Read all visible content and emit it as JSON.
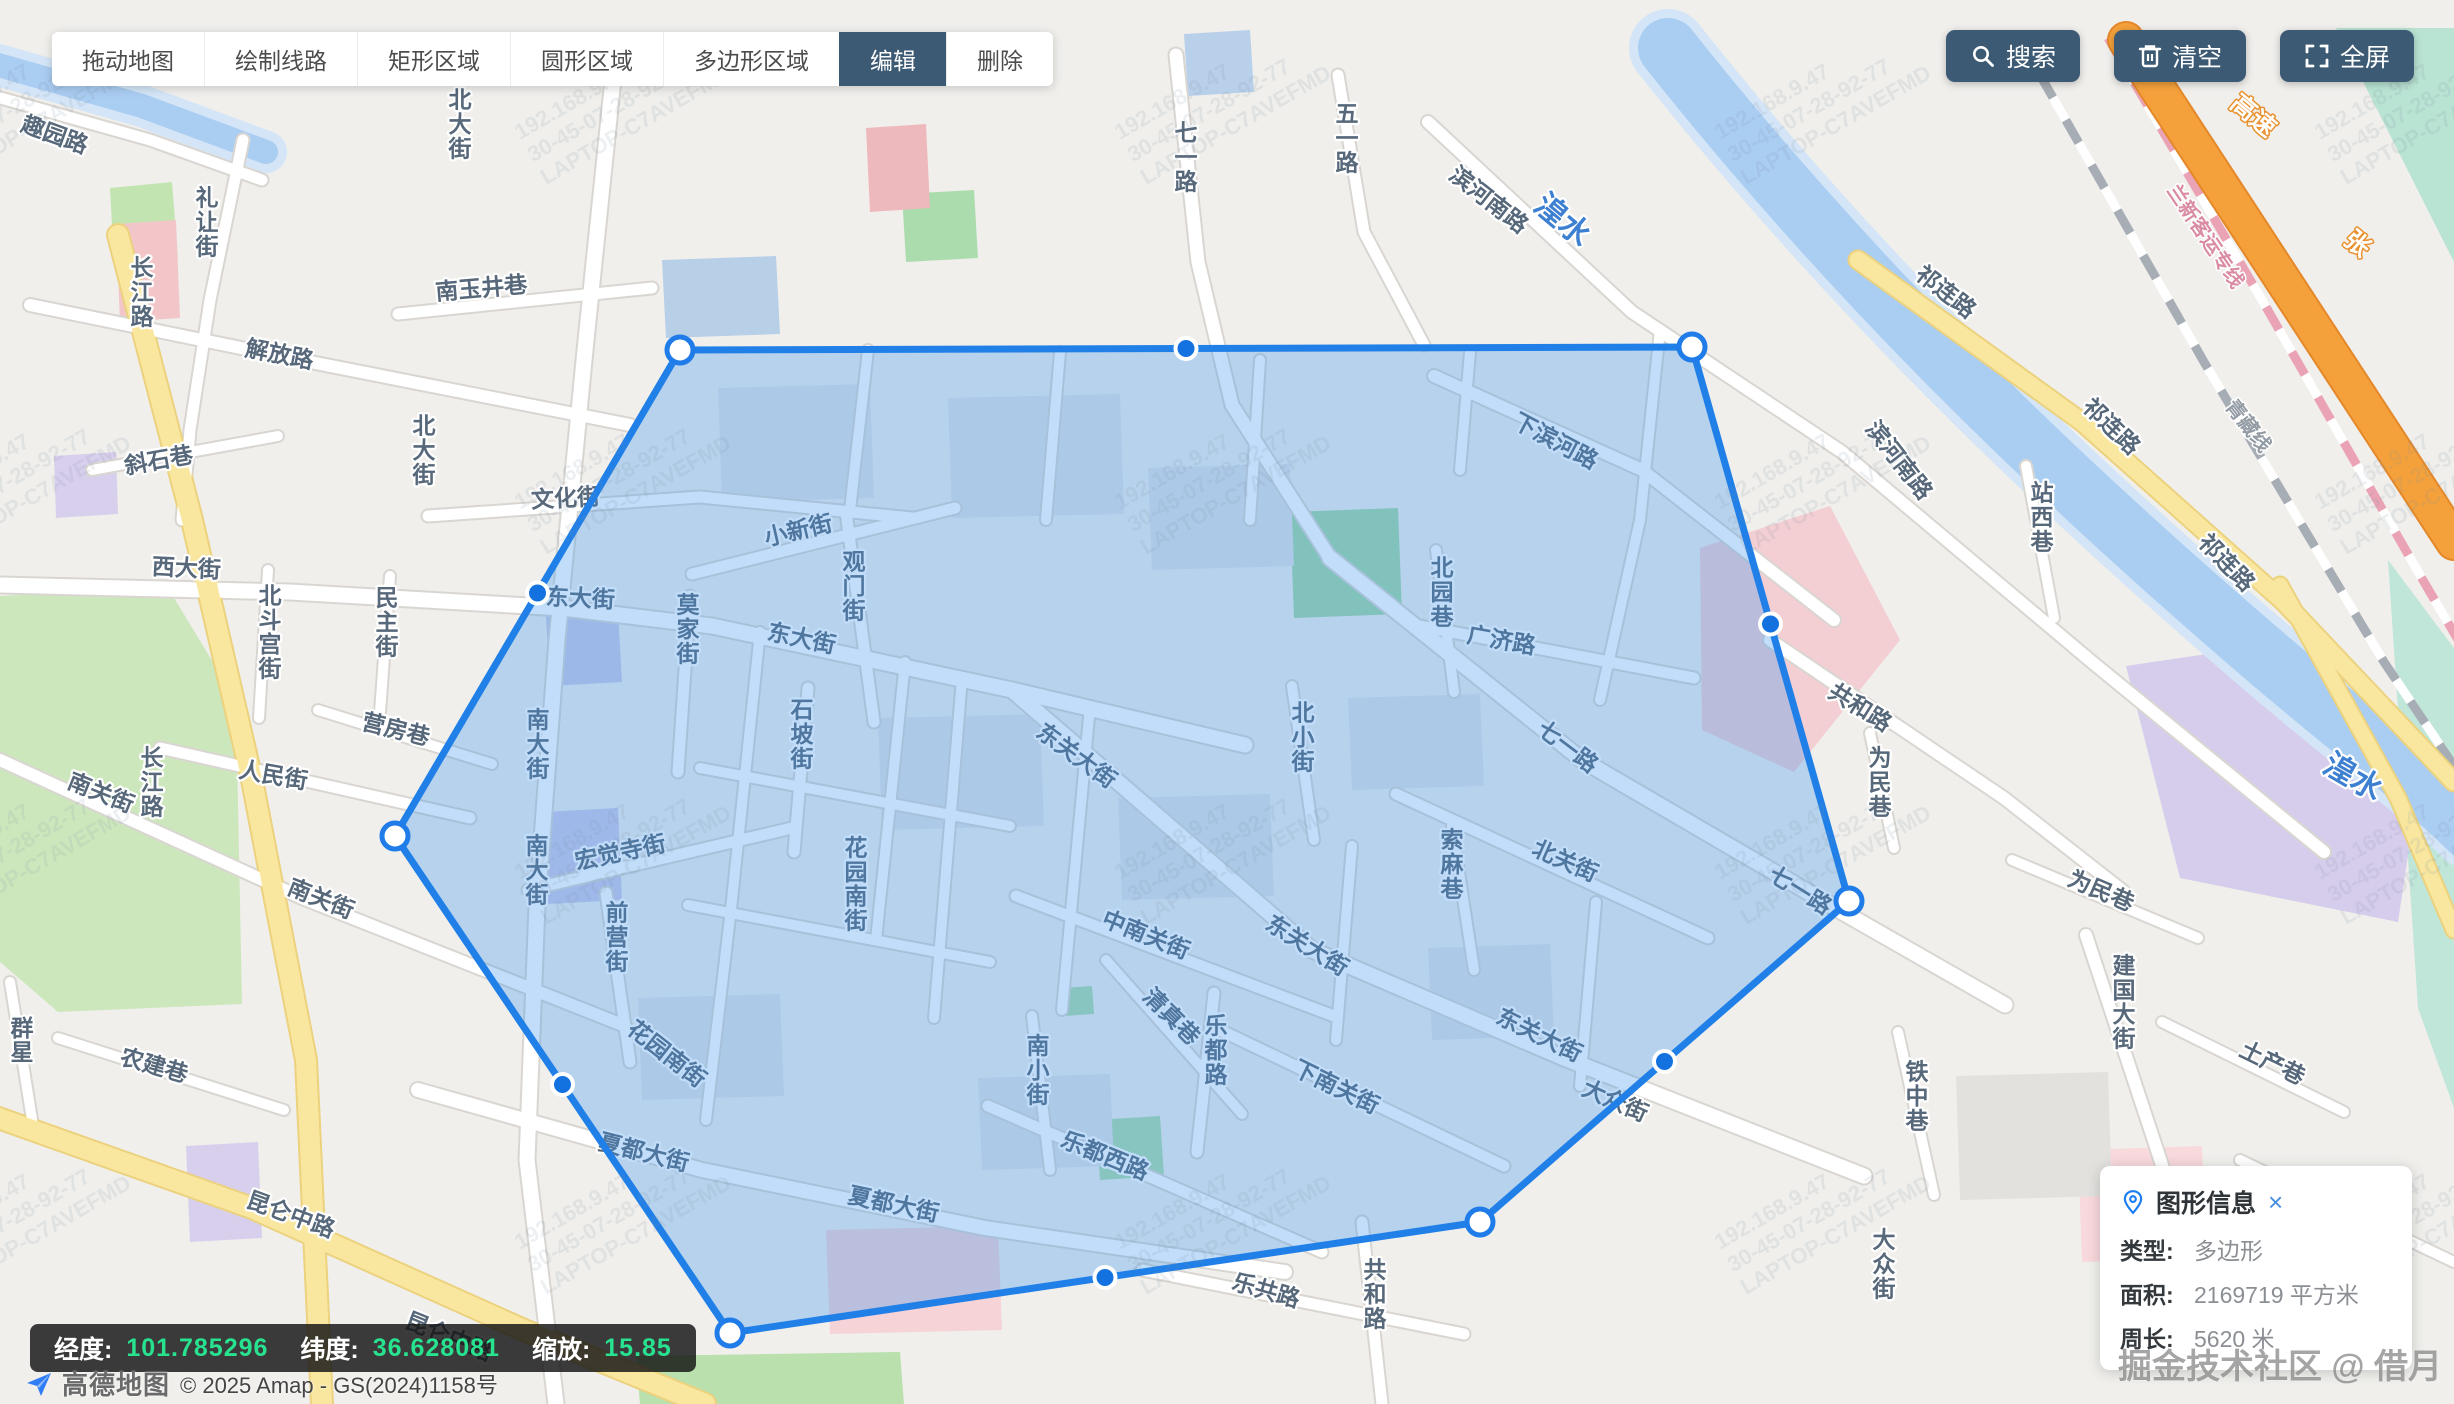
{
  "toolbar": {
    "buttons": [
      {
        "name": "tool-drag-map",
        "label": "拖动地图",
        "active": false
      },
      {
        "name": "tool-draw-line",
        "label": "绘制线路",
        "active": false
      },
      {
        "name": "tool-rect-area",
        "label": "矩形区域",
        "active": false
      },
      {
        "name": "tool-circle-area",
        "label": "圆形区域",
        "active": false
      },
      {
        "name": "tool-polygon-area",
        "label": "多边形区域",
        "active": false
      },
      {
        "name": "tool-edit",
        "label": "编辑",
        "active": true
      },
      {
        "name": "tool-delete",
        "label": "删除",
        "active": false
      }
    ],
    "actions": [
      {
        "name": "search-button",
        "icon": "search-icon",
        "label": "搜索"
      },
      {
        "name": "clear-button",
        "icon": "trash-icon",
        "label": "清空"
      },
      {
        "name": "fullscreen-button",
        "icon": "fullscreen-icon",
        "label": "全屏"
      }
    ],
    "active_bg": "#3d5a74"
  },
  "statusbar": {
    "items": [
      {
        "label": "经度:",
        "value": "101.785296"
      },
      {
        "label": "纬度:",
        "value": "36.628081"
      },
      {
        "label": "缩放:",
        "value": "15.85"
      }
    ],
    "value_color": "#27e28f"
  },
  "attribution": {
    "logo_text": "高德地图",
    "copyright": "© 2025 Amap - GS(2024)1158号"
  },
  "info_panel": {
    "title": "图形信息",
    "close_label": "×",
    "rows": [
      {
        "label": "类型:",
        "value": "多边形"
      },
      {
        "label": "面积:",
        "value": "2169719 平方米"
      },
      {
        "label": "周长:",
        "value": "5620 米"
      }
    ]
  },
  "community_watermark": {
    "text": "掘金技术社区 @ 借月"
  },
  "tile_watermark": {
    "lines": [
      "192.168.9.47",
      "30-45-07-28-92-77",
      "LAPTOP-C7AVEFMD"
    ]
  },
  "map": {
    "colors": {
      "land": "#f0efec",
      "road_fill": "#ffffff",
      "road_casing": "#d9d6d2",
      "yellow_fill": "#f9e7a0",
      "yellow_casing": "#ecd27e",
      "orange_fill": "#f4a13b",
      "orange_casing": "#e4882a",
      "river": "#aacdf2",
      "river_shore": "#d3e5f7",
      "polygon_fill": "rgba(62,148,235,0.32)",
      "polygon_stroke": "#2080e8",
      "vertex_fill": "#ffffff",
      "vertex_stroke": "#1f7ce8",
      "midpoint_fill": "#1472e0",
      "midpoint_stroke": "#ffffff"
    },
    "region_polygon": {
      "vertices": [
        [
          680,
          350
        ],
        [
          1692,
          347
        ],
        [
          1849,
          901
        ],
        [
          1480,
          1222
        ],
        [
          730,
          1333
        ],
        [
          395,
          836
        ]
      ]
    },
    "areas": [
      {
        "pts": "0,596 168,588 236,700 242,1004 58,1012 0,962",
        "fill": "#cde7bd"
      },
      {
        "pts": "110,188 172,182 178,258 114,262",
        "fill": "#c2e4b0"
      },
      {
        "pts": "1290,512 1398,508 1402,614 1294,618",
        "fill": "#a2d8a6"
      },
      {
        "pts": "902,194 974,190 978,258 906,262",
        "fill": "#abdcad"
      },
      {
        "pts": "1062,988 1092,986 1094,1014 1064,1016",
        "fill": "#abdcad"
      },
      {
        "pts": "1096,1120 1160,1116 1164,1176 1100,1180",
        "fill": "#abdcad"
      },
      {
        "pts": "636,1356 900,1352 904,1404 640,1404",
        "fill": "#b9e0ad"
      },
      {
        "pts": "2336,28 2454,28 2454,262",
        "fill": "#b9e3d3"
      },
      {
        "pts": "2388,560 2454,648 2454,1108 2418,1008",
        "fill": "#bfe6d9"
      },
      {
        "pts": "116,224 176,220 180,318 120,322",
        "fill": "#f2c6c8"
      },
      {
        "pts": "1700,548 1830,506 1900,640 1794,772 1702,730",
        "fill": "#f3ced3"
      },
      {
        "pts": "826,1230 998,1226 1002,1330 830,1334",
        "fill": "#f6d3d7"
      },
      {
        "pts": "2078,1150 2202,1146 2206,1258 2082,1262",
        "fill": "#f8d9dc"
      },
      {
        "pts": "866,128 926,124 930,208 870,212",
        "fill": "#eeb9bd"
      },
      {
        "pts": "54,456 116,452 118,514 56,518",
        "fill": "#d8cfec"
      },
      {
        "pts": "186,1146 258,1142 262,1238 190,1242",
        "fill": "#d8cfec"
      },
      {
        "pts": "546,616 618,612 622,682 550,686",
        "fill": "#c9c9e8"
      },
      {
        "pts": "544,812 618,808 622,900 548,904",
        "fill": "#cdc9e9"
      },
      {
        "pts": "2126,666 2300,640 2422,762 2398,922 2180,878",
        "fill": "#d6cdec"
      },
      {
        "pts": "662,260 776,256 780,334 666,338",
        "fill": "#b8cfe8"
      },
      {
        "pts": "1184,34 1250,30 1254,92 1188,96",
        "fill": "#b9d0ea"
      },
      {
        "pts": "1956,1076 2108,1072 2112,1196 1960,1200",
        "fill": "#e3e1de"
      },
      {
        "pts": "718,388 870,384 874,498 722,502",
        "fill": "#e0e2e6"
      },
      {
        "pts": "948,398 1120,394 1124,514 952,518",
        "fill": "#e0e2e6"
      },
      {
        "pts": "1148,468 1290,464 1294,566 1152,570",
        "fill": "#e0e2e6"
      },
      {
        "pts": "878,718 1040,714 1044,826 882,830",
        "fill": "#e0e2e6"
      },
      {
        "pts": "1118,798 1270,794 1274,896 1122,900",
        "fill": "#e0e2e6"
      },
      {
        "pts": "1348,698 1480,694 1484,786 1352,790",
        "fill": "#e0e2e6"
      },
      {
        "pts": "638,998 780,994 784,1096 642,1100",
        "fill": "#e0e2e6"
      },
      {
        "pts": "978,1078 1110,1074 1114,1166 982,1170",
        "fill": "#e0e2e6"
      },
      {
        "pts": "1428,948 1550,944 1554,1036 1432,1040",
        "fill": "#e0e2e6"
      }
    ],
    "rivers": [
      {
        "d": "M1668,48 C1860,290 2060,480 2260,652 C2360,738 2420,780 2470,830",
        "w": 60
      },
      {
        "d": "M-12,62 L142,106 L266,152",
        "w": 24
      }
    ],
    "railways": [
      {
        "d": "M2040,75 L2204,362 L2384,662 L2460,775",
        "c": "#a7adb4"
      },
      {
        "d": "M2108,38 L2262,300 L2424,582 L2470,660",
        "c": "#eaa3b4"
      }
    ],
    "roads": [
      {
        "d": "M615,60 L585,350 L557,640 L537,905 L527,1160 L556,1404",
        "t": "w",
        "w": 15
      },
      {
        "d": "M0,585 L290,592 L562,608 L712,626 L1012,690 L1245,745",
        "t": "w",
        "w": 15
      },
      {
        "d": "M1012,690 L1312,950 L1564,1058 L1864,1176",
        "t": "w",
        "w": 15
      },
      {
        "d": "M30,305 L300,360 L630,425",
        "t": "w",
        "w": 12
      },
      {
        "d": "M243,140 L210,300 L190,430 L182,520",
        "t": "w",
        "w": 11
      },
      {
        "d": "M398,314 L652,288",
        "t": "w",
        "w": 11
      },
      {
        "d": "M428,516 L700,497 L912,518",
        "t": "w",
        "w": 11
      },
      {
        "d": "M692,574 L955,508",
        "t": "w",
        "w": 11
      },
      {
        "d": "M846,512 L874,722",
        "t": "w",
        "w": 11
      },
      {
        "d": "M690,596 L678,772",
        "t": "w",
        "w": 11
      },
      {
        "d": "M808,688 L794,852",
        "t": "w",
        "w": 11
      },
      {
        "d": "M528,890 L792,828",
        "t": "w",
        "w": 11
      },
      {
        "d": "M606,893 L630,1062",
        "t": "w",
        "w": 11
      },
      {
        "d": "M160,748 L470,818",
        "t": "w",
        "w": 11
      },
      {
        "d": "M318,710 L492,764",
        "t": "w",
        "w": 10
      },
      {
        "d": "M390,576 L379,726",
        "t": "w",
        "w": 10
      },
      {
        "d": "M268,570 L259,718",
        "t": "w",
        "w": 10
      },
      {
        "d": "M0,760 L302,898 L625,1026",
        "t": "w",
        "w": 12
      },
      {
        "d": "M418,1090 L702,1170 L985,1228 L1285,1272",
        "t": "w",
        "w": 14
      },
      {
        "d": "M1214,993 L1197,1152",
        "t": "w",
        "w": 11
      },
      {
        "d": "M988,1106 L1322,1252",
        "t": "w",
        "w": 11
      },
      {
        "d": "M1016,896 L1334,1016",
        "t": "w",
        "w": 11
      },
      {
        "d": "M1106,960 L1242,1114",
        "t": "w",
        "w": 10
      },
      {
        "d": "M1032,1016 L1050,1170",
        "t": "w",
        "w": 10
      },
      {
        "d": "M1224,1032 L1504,1166",
        "t": "w",
        "w": 11
      },
      {
        "d": "M1396,794 L1708,938",
        "t": "w",
        "w": 11
      },
      {
        "d": "M1452,826 L1474,970",
        "t": "w",
        "w": 10
      },
      {
        "d": "M1292,686 L1314,840",
        "t": "w",
        "w": 10
      },
      {
        "d": "M1330,558 L1582,760 L1832,906 L2005,1005",
        "t": "w",
        "w": 15
      },
      {
        "d": "M1420,626 L1694,678",
        "t": "w",
        "w": 11
      },
      {
        "d": "M1436,550 L1454,692",
        "t": "w",
        "w": 10
      },
      {
        "d": "M1434,376 L1642,470 L1834,620",
        "t": "w",
        "w": 12
      },
      {
        "d": "M1770,640 L2004,798 L2124,892",
        "t": "w",
        "w": 12
      },
      {
        "d": "M1362,1222 L1382,1404",
        "t": "w",
        "w": 11
      },
      {
        "d": "M1142,1270 L1464,1334",
        "t": "w",
        "w": 11
      },
      {
        "d": "M1870,733 L1894,848",
        "t": "w",
        "w": 10
      },
      {
        "d": "M2012,860 L2198,938",
        "t": "w",
        "w": 10
      },
      {
        "d": "M2086,935 L2162,1165 L2202,1340",
        "t": "w",
        "w": 12
      },
      {
        "d": "M2162,1022 L2344,1112",
        "t": "w",
        "w": 10
      },
      {
        "d": "M1898,1032 L1934,1195",
        "t": "w",
        "w": 10
      },
      {
        "d": "M1428,122 L1632,312 L1842,452 L2092,662 L2324,852",
        "t": "w",
        "w": 12
      },
      {
        "d": "M1338,75 L1364,232 L1424,345",
        "t": "w",
        "w": 11
      },
      {
        "d": "M1176,55 L1198,262 L1232,405 L1330,558",
        "t": "w",
        "w": 13
      },
      {
        "d": "M2026,466 L2054,618",
        "t": "w",
        "w": 10
      },
      {
        "d": "M58,1038 L284,1110",
        "t": "w",
        "w": 10
      },
      {
        "d": "M10,982 L34,1132",
        "t": "w",
        "w": 10
      },
      {
        "d": "M92,470 L278,436",
        "t": "w",
        "w": 10
      },
      {
        "d": "M-10,95 L150,140 L262,180",
        "t": "w",
        "w": 11
      },
      {
        "d": "M760,632 L732,900 L706,1120",
        "t": "w",
        "w": 10
      },
      {
        "d": "M905,662 L876,940",
        "t": "w",
        "w": 10
      },
      {
        "d": "M962,678 L934,1018",
        "t": "w",
        "w": 10
      },
      {
        "d": "M1090,706 L1062,1010",
        "t": "w",
        "w": 10
      },
      {
        "d": "M700,768 L1010,826",
        "t": "w",
        "w": 10
      },
      {
        "d": "M688,905 L990,962",
        "t": "w",
        "w": 10
      },
      {
        "d": "M1352,846 L1336,1040",
        "t": "w",
        "w": 10
      },
      {
        "d": "M1596,902 L1580,1086",
        "t": "w",
        "w": 10
      },
      {
        "d": "M1660,330 L1640,520 L1600,700",
        "t": "w",
        "w": 10
      },
      {
        "d": "M868,350 L850,510",
        "t": "w",
        "w": 10
      },
      {
        "d": "M1060,352 L1046,520",
        "t": "w",
        "w": 10
      },
      {
        "d": "M1260,360 L1250,520",
        "t": "w",
        "w": 10
      },
      {
        "d": "M1470,352 L1460,470",
        "t": "w",
        "w": 10
      },
      {
        "d": "M2240,1160 L2454,1262",
        "t": "w",
        "w": 10
      },
      {
        "d": "M118,235 L192,520 L252,780 L306,1060 L322,1404",
        "t": "y",
        "w": 20
      },
      {
        "d": "M-10,1115 L252,1208 L524,1330 L705,1404",
        "t": "y",
        "w": 20
      },
      {
        "d": "M1858,260 L2082,422 L2284,602 L2454,782",
        "t": "y",
        "w": 17
      },
      {
        "d": "M2280,585 L2398,798 L2454,930",
        "t": "y",
        "w": 15
      },
      {
        "d": "M2126,40 L2454,542",
        "t": "o",
        "w": 34
      }
    ],
    "labels": [
      {
        "t": "趣园路",
        "x": 52,
        "y": 142,
        "r": 20
      },
      {
        "t": "长江路",
        "x": 142,
        "y": 300,
        "v": 1
      },
      {
        "t": "长江路",
        "x": 152,
        "y": 790,
        "v": 1
      },
      {
        "t": "礼让街",
        "x": 207,
        "y": 230,
        "v": 1
      },
      {
        "t": "南玉井巷",
        "x": 482,
        "y": 296,
        "r": -5
      },
      {
        "t": "解放路",
        "x": 278,
        "y": 362,
        "r": 11
      },
      {
        "t": "斜石巷",
        "x": 160,
        "y": 468,
        "r": -10
      },
      {
        "t": "北大街",
        "x": 460,
        "y": 132,
        "v": 1
      },
      {
        "t": "北大街",
        "x": 424,
        "y": 458,
        "v": 1
      },
      {
        "t": "西大街",
        "x": 186,
        "y": 576,
        "r": 3
      },
      {
        "t": "文化街",
        "x": 566,
        "y": 506,
        "r": -3
      },
      {
        "t": "民主街",
        "x": 387,
        "y": 630,
        "v": 1
      },
      {
        "t": "北斗宫街",
        "x": 270,
        "y": 640,
        "v": 1
      },
      {
        "t": "营房巷",
        "x": 394,
        "y": 737,
        "r": 14
      },
      {
        "t": "人民街",
        "x": 272,
        "y": 783,
        "r": 10
      },
      {
        "t": "南关街",
        "x": 98,
        "y": 800,
        "r": 22
      },
      {
        "t": "南关街",
        "x": 318,
        "y": 906,
        "r": 22
      },
      {
        "t": "群星",
        "x": 22,
        "y": 1048,
        "v": 1
      },
      {
        "t": "农建巷",
        "x": 152,
        "y": 1073,
        "r": 16
      },
      {
        "t": "昆仑中路",
        "x": 288,
        "y": 1222,
        "r": 20
      },
      {
        "t": "昆仑中路",
        "x": 446,
        "y": 1344,
        "r": 22
      },
      {
        "t": "东大街",
        "x": 580,
        "y": 606,
        "r": 3
      },
      {
        "t": "小新街",
        "x": 800,
        "y": 538,
        "r": -13
      },
      {
        "t": "观门街",
        "x": 854,
        "y": 594,
        "v": 1
      },
      {
        "t": "莫家街",
        "x": 688,
        "y": 637,
        "v": 1
      },
      {
        "t": "东大街",
        "x": 800,
        "y": 646,
        "r": 12
      },
      {
        "t": "石坡街",
        "x": 802,
        "y": 742,
        "v": 1
      },
      {
        "t": "南大街",
        "x": 538,
        "y": 752,
        "v": 1
      },
      {
        "t": "南大街",
        "x": 537,
        "y": 878,
        "v": 1
      },
      {
        "t": "宏觉寺街",
        "x": 622,
        "y": 860,
        "r": -12
      },
      {
        "t": "前营街",
        "x": 617,
        "y": 945,
        "v": 1
      },
      {
        "t": "花园南街",
        "x": 856,
        "y": 892,
        "v": 1
      },
      {
        "t": "花园南街",
        "x": 662,
        "y": 1060,
        "r": 38
      },
      {
        "t": "夏都大街",
        "x": 642,
        "y": 1160,
        "r": 14
      },
      {
        "t": "夏都大街",
        "x": 892,
        "y": 1212,
        "r": 12
      },
      {
        "t": "东关大街",
        "x": 1072,
        "y": 762,
        "r": 36
      },
      {
        "t": "东关大街",
        "x": 1303,
        "y": 952,
        "r": 32
      },
      {
        "t": "东关大街",
        "x": 1536,
        "y": 1042,
        "r": 26
      },
      {
        "t": "中南关街",
        "x": 1143,
        "y": 942,
        "r": 22
      },
      {
        "t": "清真巷",
        "x": 1166,
        "y": 1022,
        "r": 45
      },
      {
        "t": "南小街",
        "x": 1038,
        "y": 1078,
        "v": 1
      },
      {
        "t": "乐都路",
        "x": 1216,
        "y": 1058,
        "v": 1
      },
      {
        "t": "乐都西路",
        "x": 1102,
        "y": 1163,
        "r": 22
      },
      {
        "t": "下南关街",
        "x": 1333,
        "y": 1094,
        "r": 26
      },
      {
        "t": "北小街",
        "x": 1303,
        "y": 745,
        "v": 1
      },
      {
        "t": "北关街",
        "x": 1562,
        "y": 868,
        "r": 24
      },
      {
        "t": "索麻巷",
        "x": 1452,
        "y": 872,
        "v": 1
      },
      {
        "t": "北园巷",
        "x": 1442,
        "y": 600,
        "v": 1
      },
      {
        "t": "广济路",
        "x": 1500,
        "y": 648,
        "r": 10
      },
      {
        "t": "七一路",
        "x": 1186,
        "y": 165,
        "v": 1
      },
      {
        "t": "五一路",
        "x": 1347,
        "y": 146,
        "v": 1
      },
      {
        "t": "七一路",
        "x": 1563,
        "y": 753,
        "r": 37
      },
      {
        "t": "七一路",
        "x": 1796,
        "y": 897,
        "r": 32
      },
      {
        "t": "下滨河路",
        "x": 1552,
        "y": 448,
        "r": 28
      },
      {
        "t": "滨河南路",
        "x": 1484,
        "y": 206,
        "r": 38
      },
      {
        "t": "滨河南路",
        "x": 1893,
        "y": 465,
        "r": 52
      },
      {
        "t": "共和路",
        "x": 1856,
        "y": 714,
        "r": 32
      },
      {
        "t": "共和路",
        "x": 1375,
        "y": 1302,
        "v": 1
      },
      {
        "t": "乐共路",
        "x": 1264,
        "y": 1298,
        "r": 16
      },
      {
        "t": "为民巷",
        "x": 1880,
        "y": 790,
        "v": 1
      },
      {
        "t": "为民巷",
        "x": 2098,
        "y": 898,
        "r": 23
      },
      {
        "t": "大众街",
        "x": 1612,
        "y": 1108,
        "r": 24
      },
      {
        "t": "大众街",
        "x": 1884,
        "y": 1272,
        "v": 1
      },
      {
        "t": "铁中巷",
        "x": 1917,
        "y": 1104,
        "v": 1
      },
      {
        "t": "建国大街",
        "x": 2124,
        "y": 1010,
        "v": 1
      },
      {
        "t": "土产巷",
        "x": 2269,
        "y": 1070,
        "r": 26
      },
      {
        "t": "祁连路",
        "x": 1941,
        "y": 298,
        "r": 38
      },
      {
        "t": "祁连路",
        "x": 2106,
        "y": 432,
        "r": 44
      },
      {
        "t": "祁连路",
        "x": 2221,
        "y": 568,
        "r": 46
      },
      {
        "t": "站西巷",
        "x": 2042,
        "y": 525,
        "v": 1
      },
      {
        "t": "湟水",
        "x": 1556,
        "y": 228,
        "r": 40,
        "c": "water",
        "s": 31
      },
      {
        "t": "湟水",
        "x": 2348,
        "y": 786,
        "r": 30,
        "c": "water",
        "s": 31
      },
      {
        "t": "兰新客运专线",
        "x": 2200,
        "y": 240,
        "r": 56,
        "c": "railp",
        "s": 20
      },
      {
        "t": "青藏线",
        "x": 2243,
        "y": 430,
        "r": 52,
        "c": "railg",
        "s": 20
      },
      {
        "t": "高速",
        "x": 2248,
        "y": 122,
        "r": 40,
        "c": "hw",
        "s": 25
      },
      {
        "t": "张",
        "x": 2352,
        "y": 250,
        "r": 40,
        "c": "hw",
        "s": 25
      }
    ]
  }
}
